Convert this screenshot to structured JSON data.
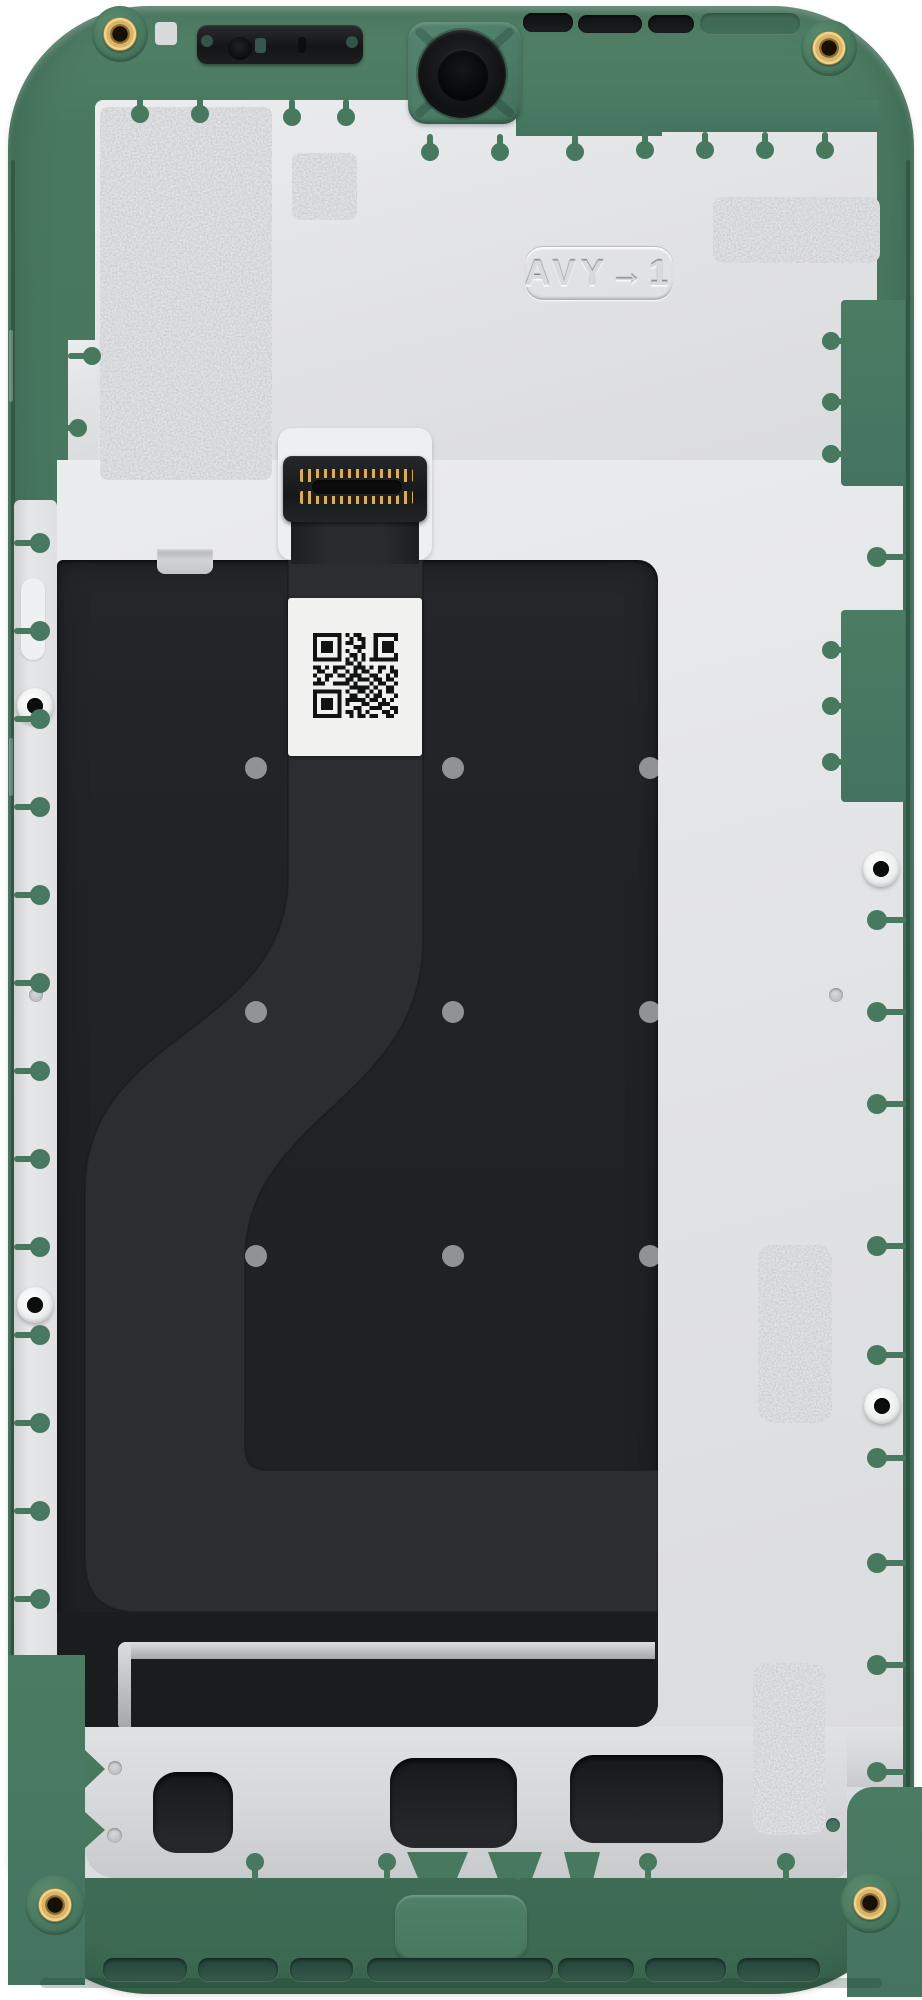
{
  "part": {
    "embossed_label": "AVY→1",
    "description": "smartphone-midframe-display-assembly-rear-view",
    "colors": {
      "frame_green": "#47795f",
      "frame_green_dark": "#3c6952",
      "frame_green_light": "#548468",
      "shield_plate_gray": "#e3e4e6",
      "display_back_black": "#202224",
      "flex_channel_black": "#2b2d30",
      "foil_silver": "#cbcdcf",
      "connector_pin_gold": "#d8ae60",
      "screw_brass_gold": "#d9b469",
      "qr_label_white": "#f1f1f0",
      "bottom_slot_green": "#2d5244"
    },
    "qr_modules": [
      "111111101011000111111",
      "100000100101100100001",
      "101110101100100101110",
      "101110100011100101110",
      "101110101001000101110",
      "100000100110100100001",
      "111111101010101111111",
      "000000001101000000000",
      "110101110011101011010",
      "011001001010110010011",
      "100110110111001100101",
      "010100001101110110110",
      "111001111010001011001",
      "000000000111110100110",
      "111111101001101010110",
      "100000100110010110001",
      "101110101111101101010",
      "101110101000110011100",
      "101110100011001110011",
      "100000101101010001101",
      "111111100101101100110"
    ]
  }
}
